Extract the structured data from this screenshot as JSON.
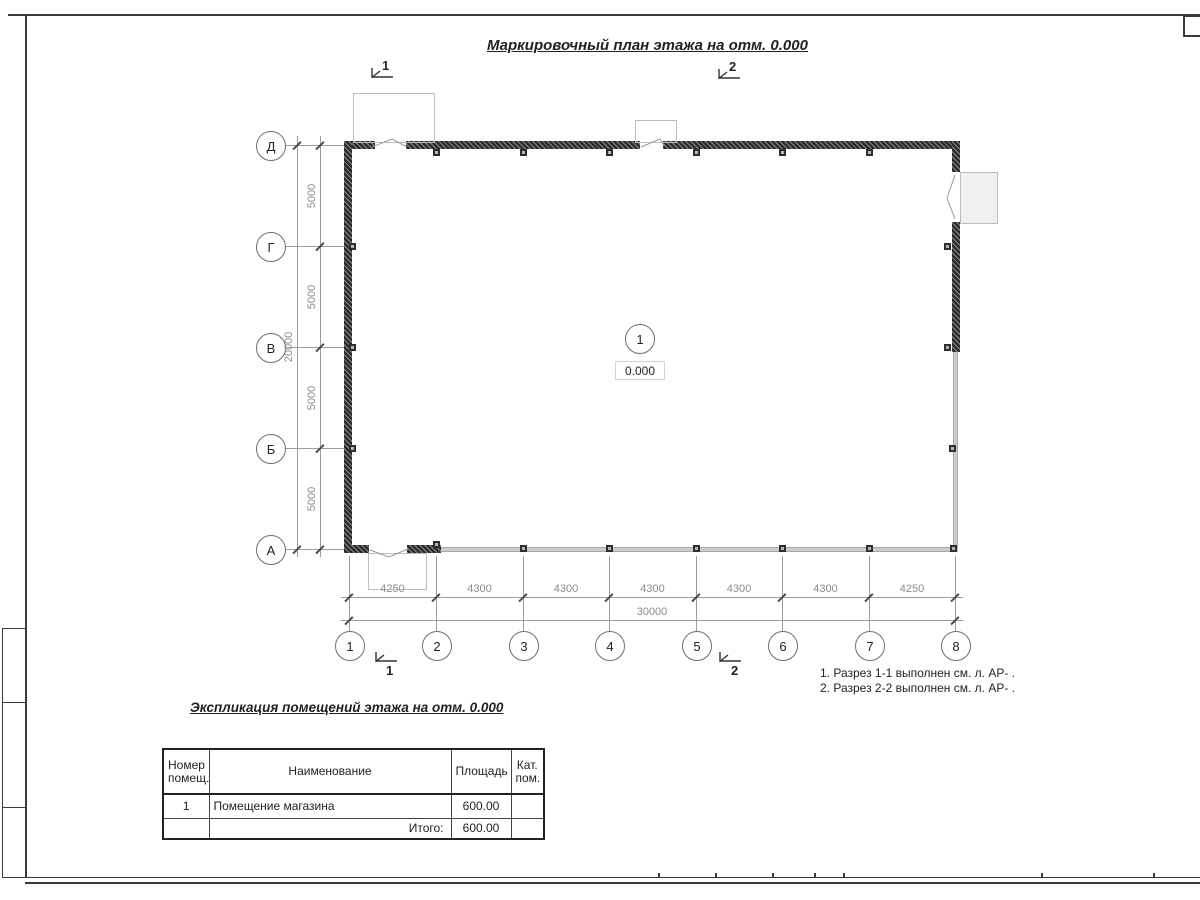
{
  "drawing": {
    "title": "Маркировочный план этажа на отм. 0.000",
    "room": {
      "number": "1",
      "elevation": "0.000"
    },
    "sections": {
      "s1": "1",
      "s2": "2"
    },
    "axes": {
      "rows": [
        "Д",
        "Г",
        "В",
        "Б",
        "А"
      ],
      "cols": [
        "1",
        "2",
        "3",
        "4",
        "5",
        "6",
        "7",
        "8"
      ]
    },
    "dims": {
      "row_segments": [
        "5000",
        "5000",
        "5000",
        "5000"
      ],
      "row_total": "20000",
      "col_segments": [
        "4250",
        "4300",
        "4300",
        "4300",
        "4300",
        "4300",
        "4250"
      ],
      "col_total": "30000"
    },
    "notes": [
      "1. Разрез 1-1 выполнен см. л. АР- .",
      "2. Разрез 2-2 выполнен см. л. АР- ."
    ]
  },
  "explication": {
    "title": "Экспликация помещений этажа на отм. 0.000",
    "headers": [
      "Номер помещ.",
      "Наименование",
      "Площадь",
      "Кат. пом."
    ],
    "rows": [
      {
        "num": "1",
        "name": "Помещение магазина",
        "area": "600.00",
        "cat": ""
      }
    ],
    "total": {
      "label": "Итого:",
      "value": "600.00"
    }
  }
}
